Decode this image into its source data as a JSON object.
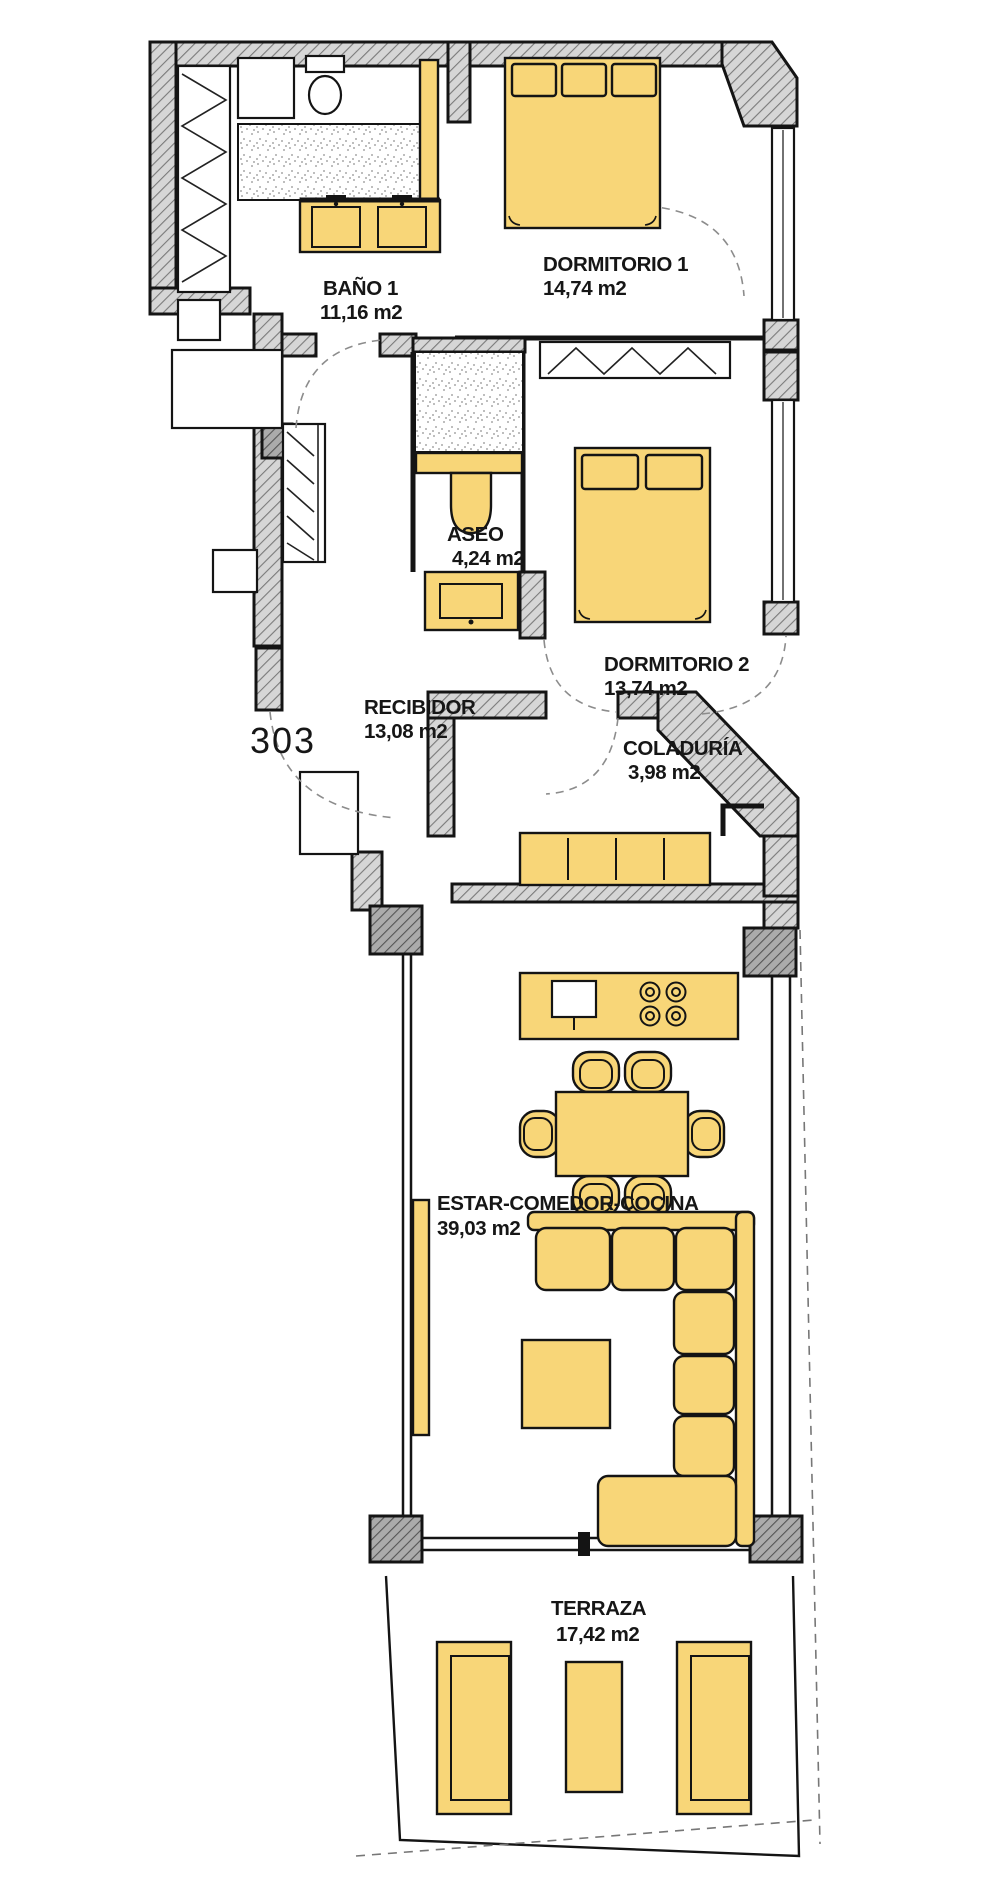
{
  "plan": {
    "apartment_number": "303",
    "rooms": [
      {
        "name": "BAÑO 1",
        "area": "11,16 m2"
      },
      {
        "name": "DORMITORIO 1",
        "area": "14,74 m2"
      },
      {
        "name": "ASEO",
        "area": "4,24 m2"
      },
      {
        "name": "DORMITORIO 2",
        "area": "13,74 m2"
      },
      {
        "name": "RECIBIDOR",
        "area": "13,08 m2"
      },
      {
        "name": "COLADURÍA",
        "area": "3,98 m2"
      },
      {
        "name": "ESTAR-COMEDOR-COCINA",
        "area": "39,03 m2"
      },
      {
        "name": "TERRAZA",
        "area": "17,42 m2"
      }
    ],
    "colors": {
      "furniture": "#F8D678",
      "wall_hatch": "#d6d6d6",
      "outline": "#141414",
      "background": "#ffffff"
    }
  }
}
